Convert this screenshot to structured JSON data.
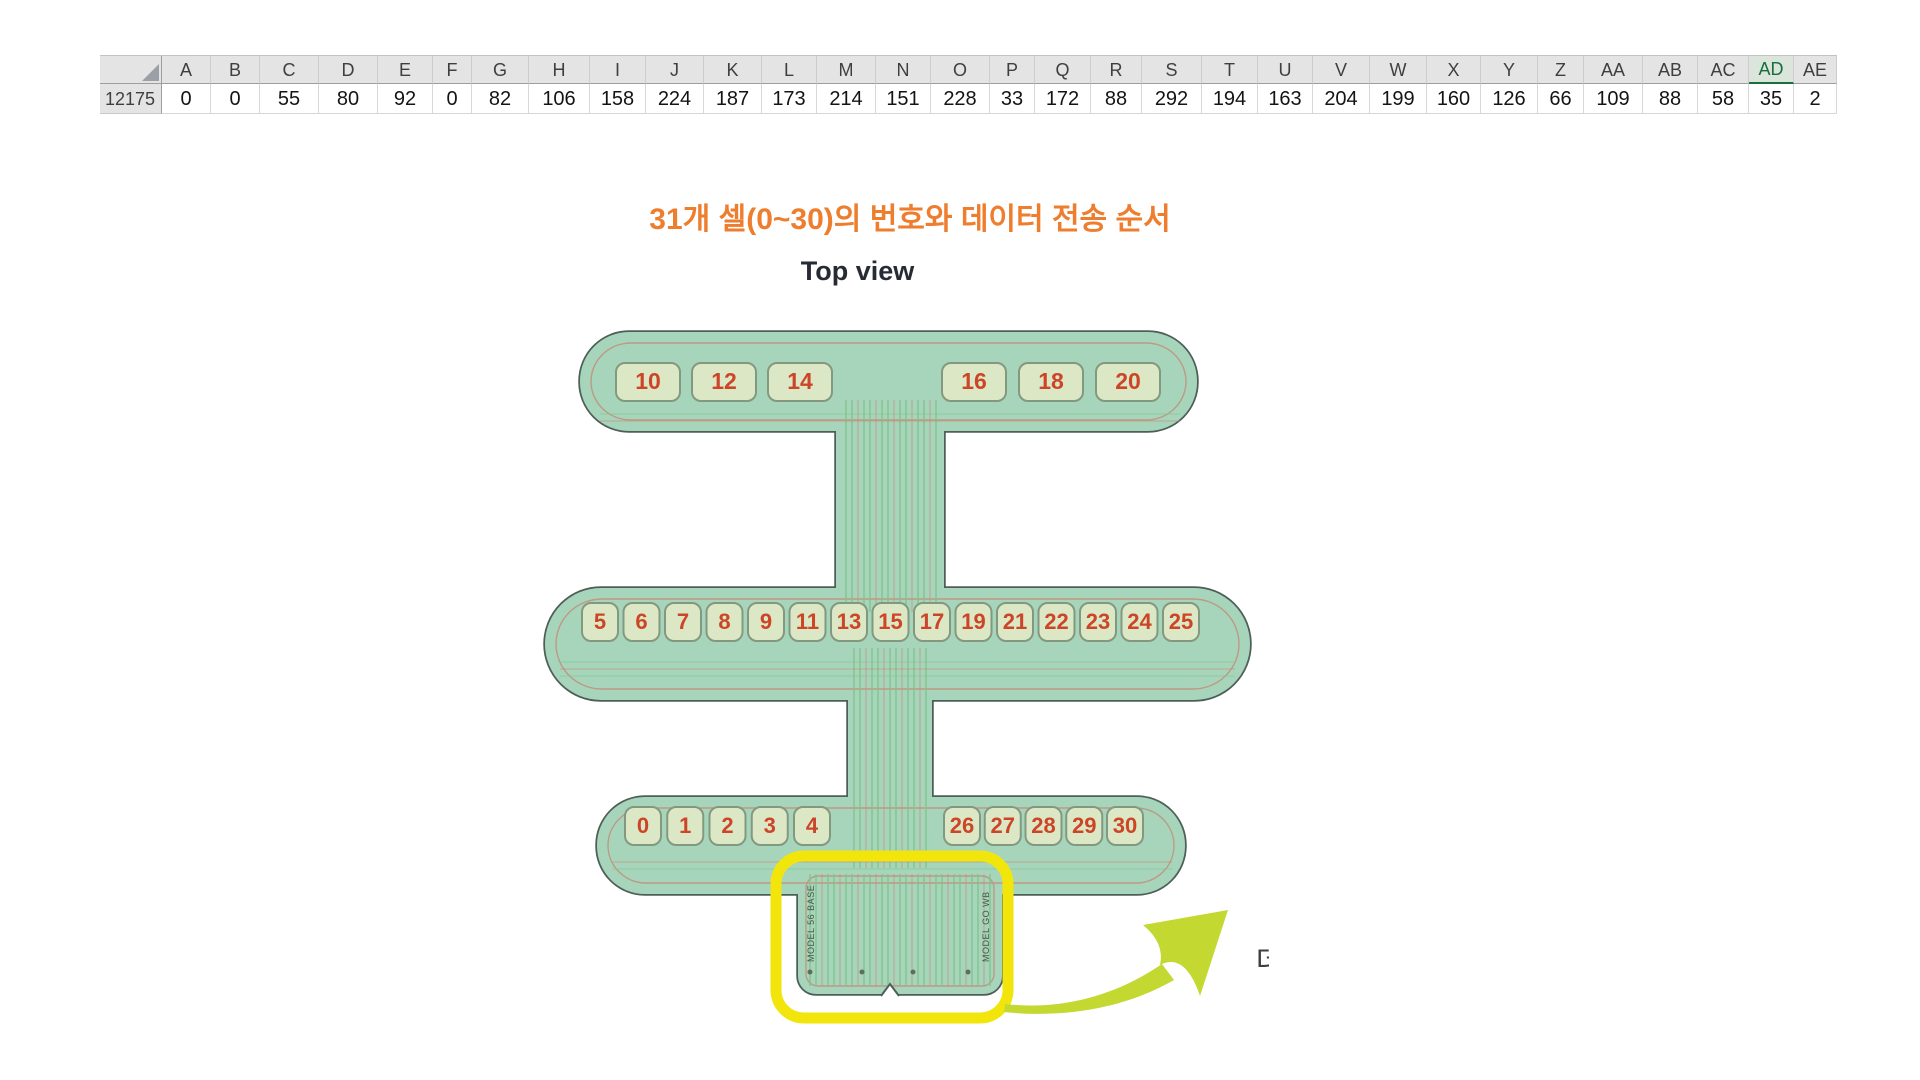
{
  "spreadsheet": {
    "row_label": "12175",
    "selected_column": "AD",
    "columns": [
      {
        "label": "A",
        "value": "0",
        "width": 49
      },
      {
        "label": "B",
        "value": "0",
        "width": 49
      },
      {
        "label": "C",
        "value": "55",
        "width": 59
      },
      {
        "label": "D",
        "value": "80",
        "width": 59
      },
      {
        "label": "E",
        "value": "92",
        "width": 55
      },
      {
        "label": "F",
        "value": "0",
        "width": 39
      },
      {
        "label": "G",
        "value": "82",
        "width": 57
      },
      {
        "label": "H",
        "value": "106",
        "width": 61
      },
      {
        "label": "I",
        "value": "158",
        "width": 56
      },
      {
        "label": "J",
        "value": "224",
        "width": 58
      },
      {
        "label": "K",
        "value": "187",
        "width": 58
      },
      {
        "label": "L",
        "value": "173",
        "width": 55
      },
      {
        "label": "M",
        "value": "214",
        "width": 59
      },
      {
        "label": "N",
        "value": "151",
        "width": 55
      },
      {
        "label": "O",
        "value": "228",
        "width": 59
      },
      {
        "label": "P",
        "value": "33",
        "width": 45
      },
      {
        "label": "Q",
        "value": "172",
        "width": 56
      },
      {
        "label": "R",
        "value": "88",
        "width": 51
      },
      {
        "label": "S",
        "value": "292",
        "width": 60
      },
      {
        "label": "T",
        "value": "194",
        "width": 56
      },
      {
        "label": "U",
        "value": "163",
        "width": 55
      },
      {
        "label": "V",
        "value": "204",
        "width": 57
      },
      {
        "label": "W",
        "value": "199",
        "width": 57
      },
      {
        "label": "X",
        "value": "160",
        "width": 54
      },
      {
        "label": "Y",
        "value": "126",
        "width": 57
      },
      {
        "label": "Z",
        "value": "66",
        "width": 46
      },
      {
        "label": "AA",
        "value": "109",
        "width": 59
      },
      {
        "label": "AB",
        "value": "88",
        "width": 55
      },
      {
        "label": "AC",
        "value": "58",
        "width": 51
      },
      {
        "label": "AD",
        "value": "35",
        "width": 45
      },
      {
        "label": "AE",
        "value": "2",
        "width": 43
      }
    ]
  },
  "figure": {
    "title": "31개 셀(0~30)의 번호와 데이터 전송 순서",
    "subtitle": "Top view",
    "cells": {
      "top_left": [
        10,
        12,
        14
      ],
      "top_right": [
        16,
        18,
        20
      ],
      "middle": [
        5,
        6,
        7,
        8,
        9,
        11,
        13,
        15,
        17,
        19,
        21,
        22,
        23,
        24,
        25
      ],
      "bottom_left": [
        0,
        1,
        2,
        3,
        4
      ],
      "bottom_right": [
        26,
        27,
        28,
        29,
        30
      ]
    },
    "connector": {
      "left_label": "MODEL 56 BASE",
      "right_label": "MODEL GO WB"
    },
    "clipped_text": "데",
    "colors": {
      "title": "#ee7d2e",
      "shape_fill": "#a7d5bc",
      "shape_stroke": "#4e5f58",
      "cell_fill": "#dce8c5",
      "cell_stroke": "#83997f",
      "cell_number": "#cd4527",
      "trace_red": "#c38b74",
      "trace_green": "#82c48a",
      "highlight_yellow": "#f2e50c",
      "arrow": "#c4d832",
      "connector_text": "#475549"
    }
  }
}
